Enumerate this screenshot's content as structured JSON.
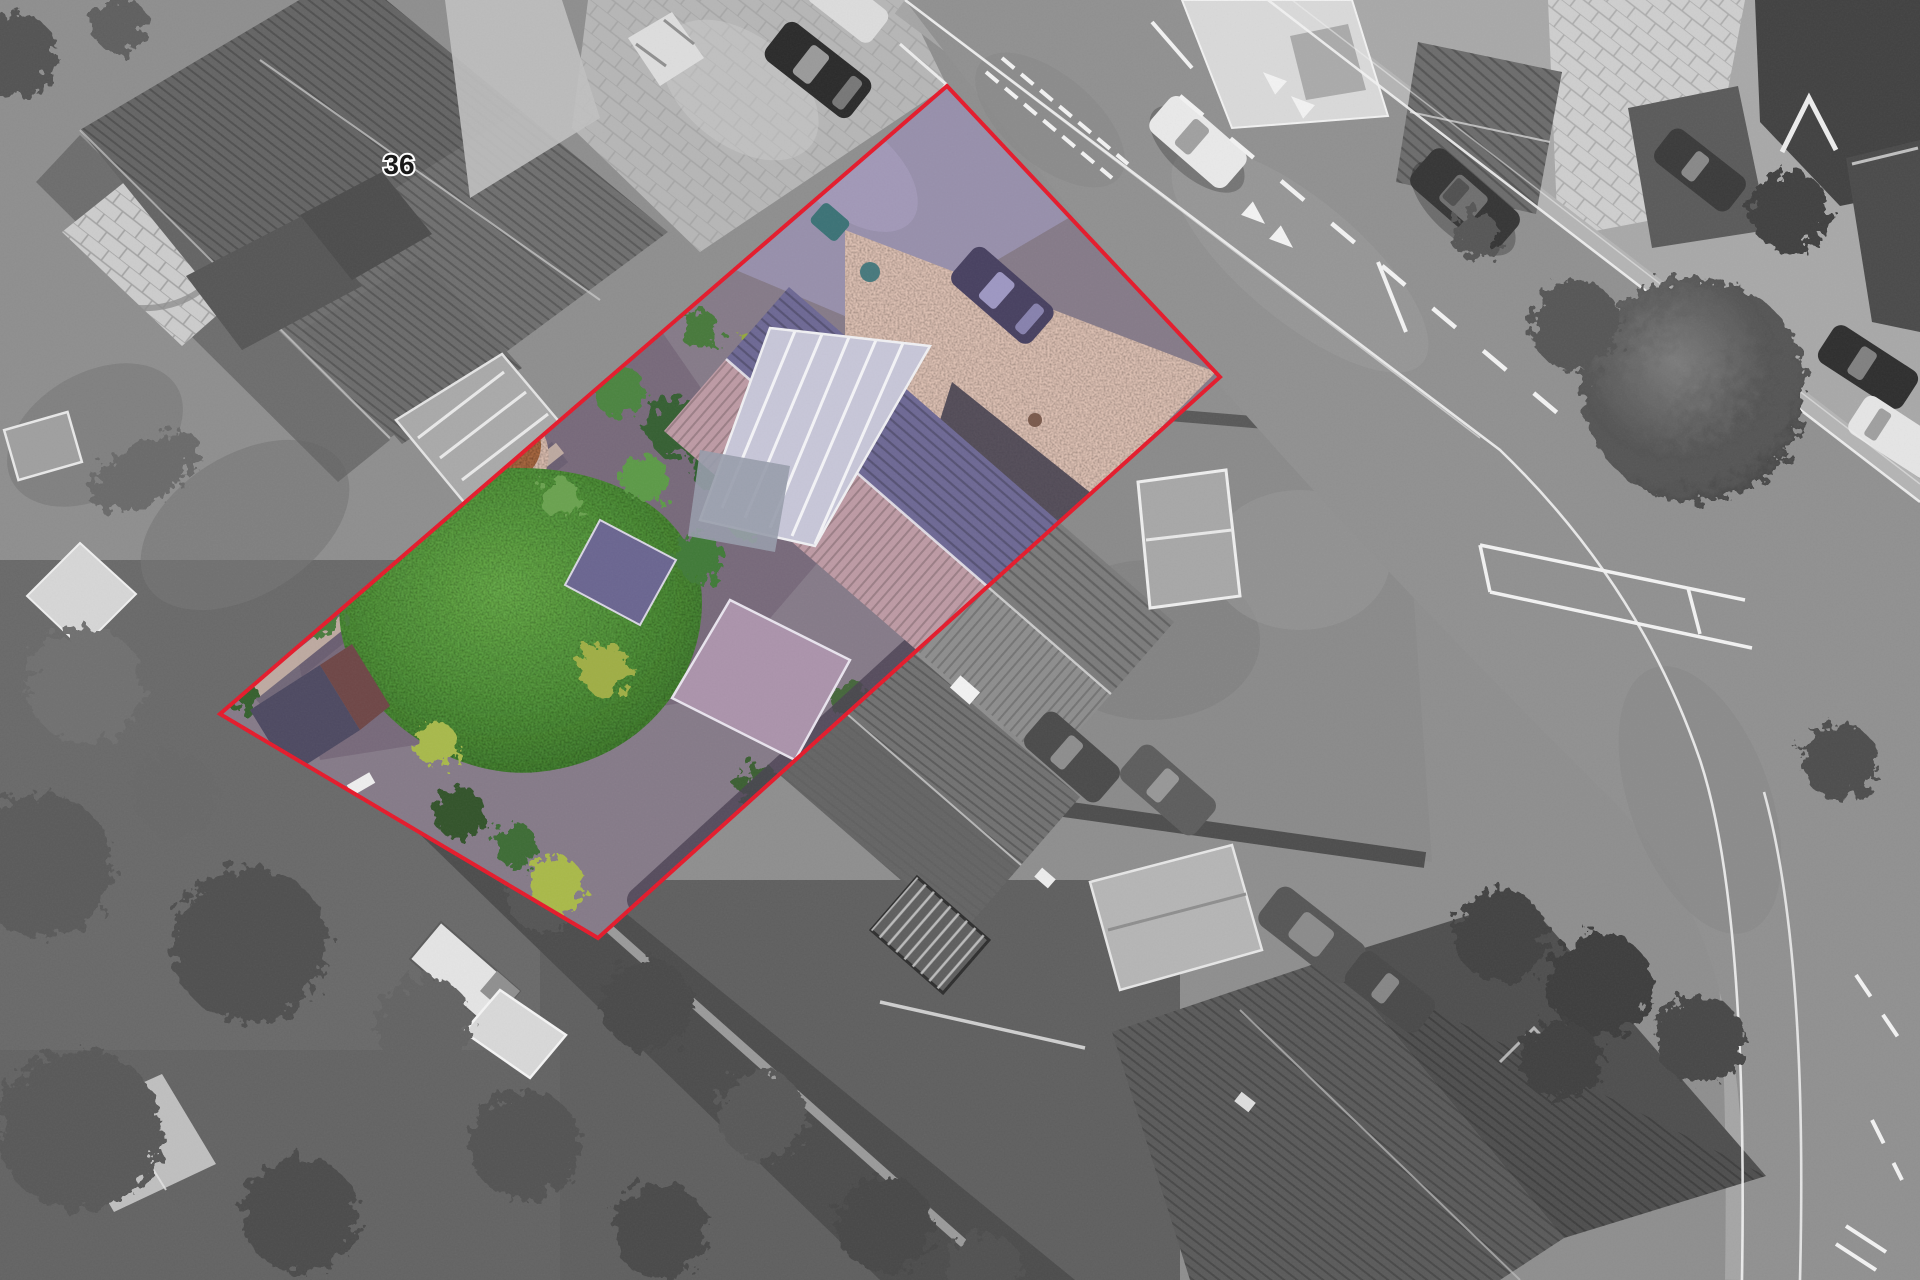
{
  "annotation": {
    "house_number_label": "36"
  },
  "label_position": {
    "x": 399,
    "y": 174
  },
  "boundary": {
    "points": "947,86 1220,377 598,938 220,714",
    "color": "#e51a2b",
    "stroke_width": 4
  },
  "palette": {
    "monochrome_base": "#8e8e8e",
    "road_gray": "#909090",
    "lawn_green": "#57953c",
    "roof_purple": "#6d6894",
    "roof_pink": "#bd9aa4",
    "conservatory_lavender": "#c7c6d8",
    "gravel_pink": "#ddc0b2",
    "drive_lilac": "#978fab",
    "site_soil": "#857a88",
    "marking_white": "#f2f2f2"
  }
}
